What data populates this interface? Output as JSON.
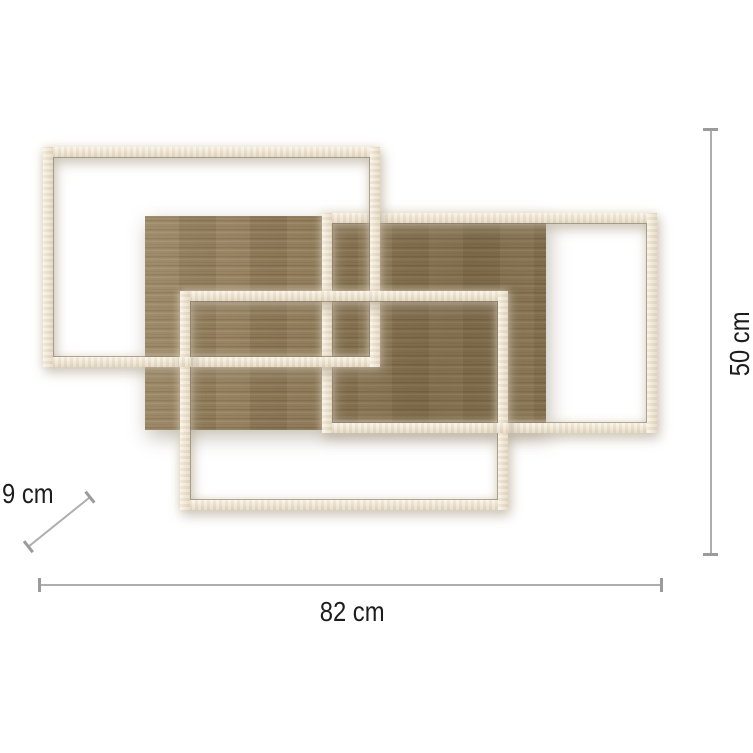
{
  "diagram": {
    "kind": "product dimension diagram",
    "product": "LED ceiling light with three interlocking light frames over an oak wood panel",
    "dimensions": {
      "width": "82 cm",
      "height": "50 cm",
      "depth": "9 cm"
    },
    "parts": {
      "wood_panel": "oak wood panel",
      "frame_top_left": "LED light frame (top left)",
      "frame_top_right": "LED light frame (top right)",
      "frame_bottom": "LED light frame (bottom center)"
    },
    "colors": {
      "background": "#ffffff",
      "frame": "#f1e8d7",
      "frame_inner_edge": "#78705e",
      "wood_base": "#8e7957",
      "dimension_line": "#aeaeae",
      "dimension_cap": "#9b9b9b",
      "label_text": "#1d1d1d"
    }
  }
}
